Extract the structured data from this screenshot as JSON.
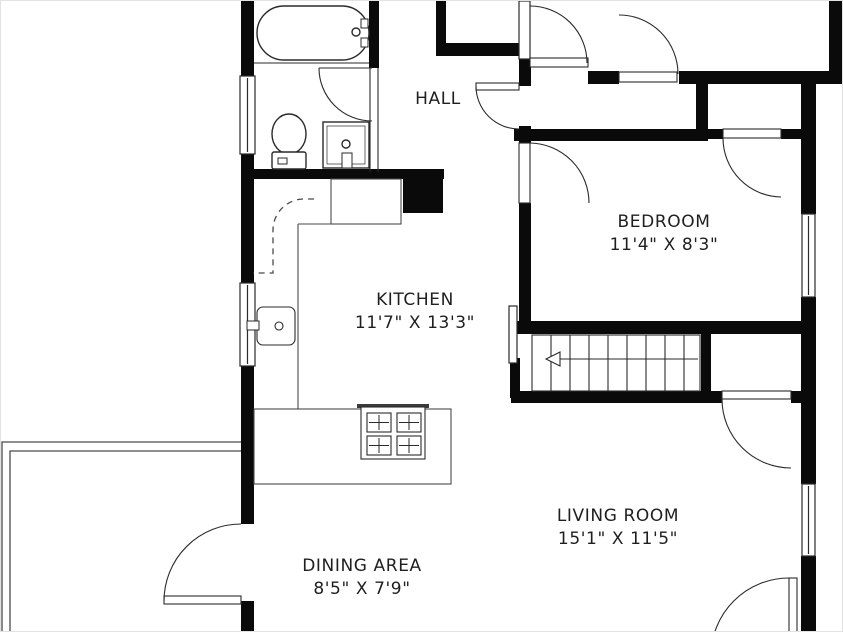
{
  "plan": {
    "type": "floor-plan",
    "colors": {
      "wall": "#0a0a0a",
      "background": "#ffffff",
      "fixture_line": "#2a2a2a",
      "furniture_line": "#4a4a4a",
      "text": "#1f1f1f"
    }
  },
  "rooms": {
    "hall": {
      "name": "HALL"
    },
    "bedroom": {
      "name": "BEDROOM",
      "dims": "11'4\" X 8'3\""
    },
    "kitchen": {
      "name": "KITCHEN",
      "dims": "11'7\" X 13'3\""
    },
    "living_room": {
      "name": "LIVING ROOM",
      "dims": "15'1\" X 11'5\""
    },
    "dining_area": {
      "name": "DINING AREA",
      "dims": "8'5\" X 7'9\""
    }
  },
  "fixtures": [
    "bathtub",
    "toilet",
    "vanity-sink",
    "kitchen-sink",
    "refrigerator",
    "stove",
    "kitchen-counter",
    "stairs",
    "stair-railing",
    "deck",
    "windows",
    "doors"
  ]
}
